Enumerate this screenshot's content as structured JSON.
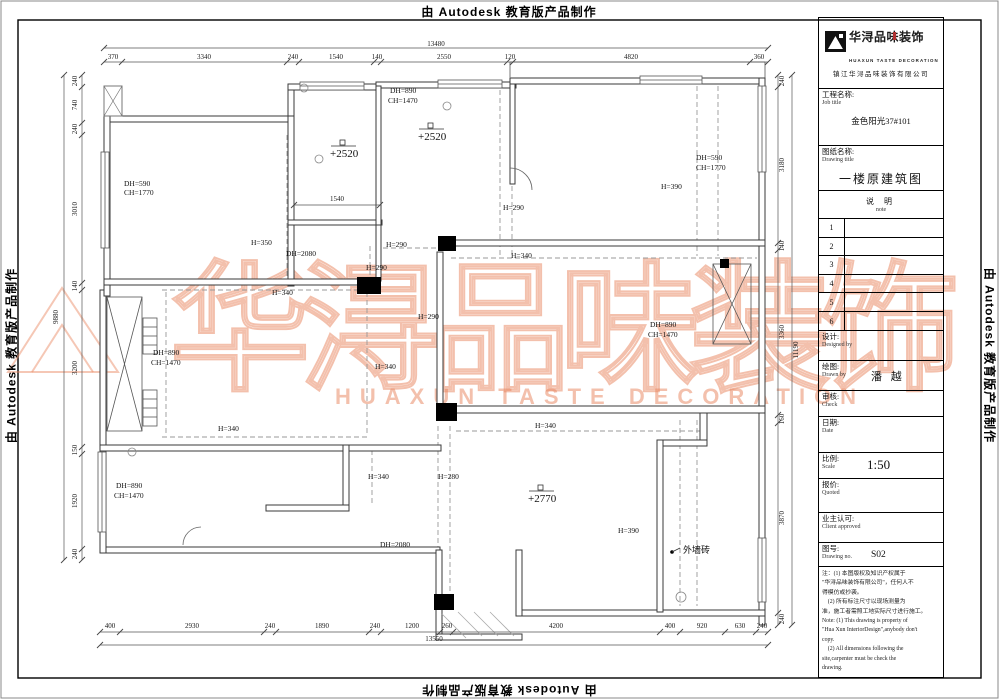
{
  "edges": {
    "autodesk": "由 Autodesk 教育版产品制作"
  },
  "watermark": {
    "cn": "华浔品味装饰",
    "latin": "HUAXUN TASTE DECORATION"
  },
  "colors": {
    "watermark": "#e8835c",
    "wall": "#3a3a3a",
    "dash": "#999999",
    "brand_red": "#b03030"
  },
  "dims": {
    "top_total": "13480",
    "top": [
      "370",
      "3340",
      "240",
      "1540",
      "140",
      "2550",
      "120",
      "4820",
      "360"
    ],
    "bottom": [
      "400",
      "2930",
      "240",
      "1890",
      "240",
      "1200",
      "260",
      "4200",
      "400",
      "920",
      "630",
      "240"
    ],
    "bottom_total": "13550",
    "left": [
      "240",
      "740",
      "240",
      "3010",
      "140",
      "3200",
      "150",
      "1920",
      "240"
    ],
    "left_total": "9880",
    "right": [
      "240",
      "3180",
      "140",
      "3360",
      "160",
      "3870",
      "240"
    ],
    "right_total": "11190",
    "inner_1540": "1540"
  },
  "labels": {
    "tl_dh": "DH=590",
    "tl_ch": "CH=1770",
    "lvl_a": "+2520",
    "h350": "H=350",
    "dh2080a": "DH=2080",
    "h340_a": "H=340",
    "tm_dh": "DH=890",
    "tm_ch": "CH=1470",
    "lvl_b": "+2520",
    "h290_a": "H=290",
    "tr_dh": "DH=590",
    "tr_ch": "CH=1770",
    "h390_a": "H=390",
    "h290_b": "H=290",
    "h340_b": "H=340",
    "h290_c": "H=290",
    "h290_d": "H=290",
    "mr_dh": "DH=890",
    "mr_ch": "CH=1470",
    "ml_dh": "DH=890",
    "ml_ch": "CH=1470",
    "h340_c": "H=340",
    "h340_d": "H=340",
    "h340_e": "H=340",
    "h280": "H=280",
    "lvl_c": "+2770",
    "bl_dh": "DH=890",
    "bl_ch": "CH=1470",
    "h340_f": "H=340",
    "dh2080b": "DH=2080",
    "h390_b": "H=390",
    "waiqiangzhuan": "外墙砖"
  },
  "titleblock": {
    "brand": "华浔品味装饰",
    "brand_latin": "HUAXUN TASTE DECORATION",
    "company": "镇江华浔品味装饰有限公司",
    "job_cn": "工程名称:",
    "job_en": "Job title",
    "job_value": "金色阳光37#101",
    "draw_cn": "图纸名称:",
    "draw_en": "Drawing title",
    "draw_value": "一楼原建筑图",
    "note_cn": "说 明",
    "note_en": "note",
    "rows": [
      "1",
      "2",
      "3",
      "4",
      "5",
      "6"
    ],
    "design_cn": "设计:",
    "design_en": "Designed by",
    "drawn_cn": "绘图:",
    "drawn_en": "Drawn by",
    "drawn_value": "潘 越",
    "check_cn": "审核:",
    "check_en": "Check",
    "date_cn": "日期:",
    "date_en": "Date",
    "scale_cn": "比例:",
    "scale_en": "Scale",
    "scale_value": "1:50",
    "quote_cn": "报价:",
    "quote_en": "Quoted",
    "appr_cn": "业主认可:",
    "appr_en": "Client approved",
    "dno_cn": "图号:",
    "dno_en": "Drawing no.",
    "dno_value": "S02",
    "notes": [
      "注：(1) 本图版权及知识产权属于",
      "\"华浔品味装饰有限公司\"，任何人不",
      "得模仿或抄袭。",
      "　(2) 所有标注尺寸以现场测量为",
      "准，施工者需照工地实际尺寸进行施工。",
      "Note: (1) This drawing is property of",
      "\"Hua Xun InteriorDesign\",anybody don't",
      "copy.",
      "　(2) All dimensions following the",
      "site,carpenter must be check the",
      "drawing."
    ]
  }
}
